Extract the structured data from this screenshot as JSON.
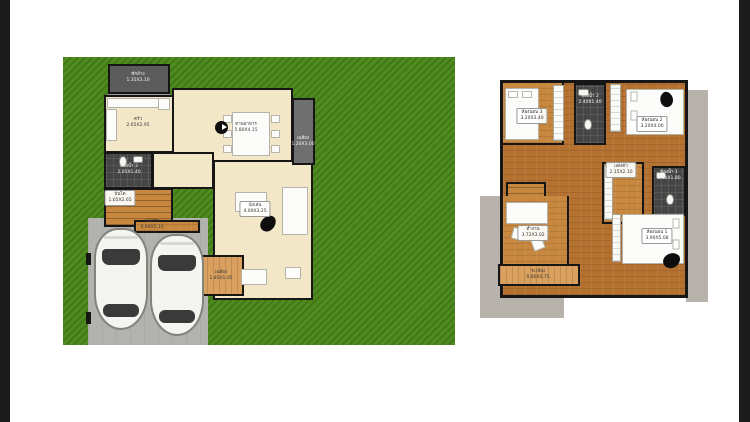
{
  "document": {
    "type": "house-floor-plan",
    "panels": [
      "first-floor-site-plan",
      "second-floor-plan"
    ]
  },
  "colors": {
    "grass": "#4f8c1e",
    "cream_floor": "#f2e7c6",
    "wood_floor": "#b4712f",
    "dark_tile": "#454545",
    "concrete": "#b7b3ac",
    "driveway": "#b2b2ae",
    "wall": "#161616",
    "edge_bar": "#1b1b1b"
  },
  "icons": {
    "north_indicator": "black-circle-with-white-arrow",
    "armchair_beanbag": "black-organic-blob",
    "car": "white-car-top-view"
  },
  "floor1": {
    "rooms": [
      {
        "id": "laundry",
        "name": "ซักล้าง",
        "dims": "1.35X3.10"
      },
      {
        "id": "kitchen",
        "name": "ครัว",
        "dims": "2.65X2.95"
      },
      {
        "id": "dining",
        "name": "ทานอาหาร",
        "dims": "5.80X4.15"
      },
      {
        "id": "bath3",
        "name": "ห้องน้ำ 3",
        "dims": "2.05X1.40"
      },
      {
        "id": "stairs",
        "name": "บันได",
        "dims": "1.05X2.65"
      },
      {
        "id": "living",
        "name": "นั่งเล่น",
        "dims": "4.00X3.25"
      },
      {
        "id": "side-porch",
        "name": "เฉลียง",
        "dims": "1.20X3.00"
      },
      {
        "id": "front-porch",
        "name": "เฉลียง",
        "dims": "1.85X1.05"
      },
      {
        "id": "carpark",
        "name": "จอดรถ",
        "dims": "4.90X5.10"
      }
    ]
  },
  "floor2": {
    "rooms": [
      {
        "id": "bed3",
        "name": "ห้องนอน 3",
        "dims": "3.20X3.40"
      },
      {
        "id": "bath2",
        "name": "ห้องน้ำ 2",
        "dims": "2.40X1.40"
      },
      {
        "id": "bed2",
        "name": "ห้องนอน 2",
        "dims": "3.20X4.00"
      },
      {
        "id": "dressing",
        "name": "แต่งตัว",
        "dims": "2.15X2.10"
      },
      {
        "id": "bath1",
        "name": "ห้องน้ำ 1",
        "dims": "2.10X1.80"
      },
      {
        "id": "study",
        "name": "ทำงาน",
        "dims": "3.72X3.02"
      },
      {
        "id": "bed1",
        "name": "ห้องนอน 1",
        "dims": "3.90X5.08"
      },
      {
        "id": "balcony",
        "name": "ระเบียง",
        "dims": "0.80X3.75"
      }
    ]
  }
}
